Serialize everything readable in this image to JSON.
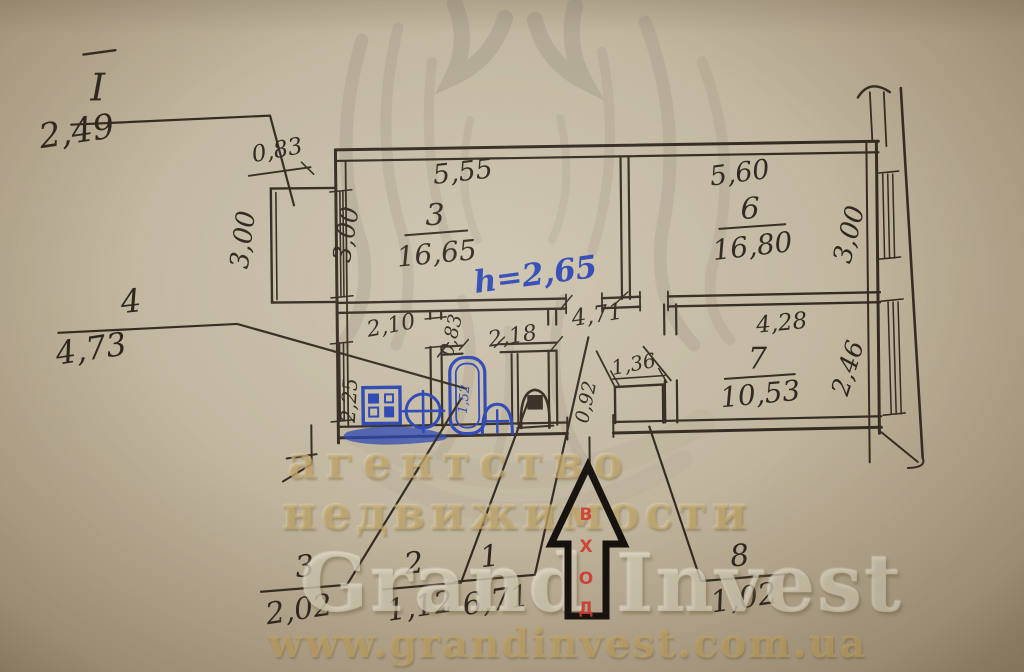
{
  "watermark": {
    "line1": "агентство",
    "line2": "недвижимости",
    "brand": "Grand Invest",
    "url": "www.grandinvest.com.ua"
  },
  "plan": {
    "height_note": "h=2,65",
    "entrance": {
      "l1": "В",
      "l2": "Х",
      "l3": "О",
      "l4": "Д"
    },
    "rooms": {
      "room3": {
        "num": "3",
        "area": "16,65"
      },
      "room6": {
        "num": "6",
        "area": "16,80"
      },
      "room7": {
        "num": "7",
        "area": "10,53"
      }
    },
    "dims": {
      "balcony_depth": "0,83",
      "balcony_height": "3,00",
      "room3_width": "5,55",
      "room3_height": "3,00",
      "room6_width": "5,60",
      "room6_height": "3,00",
      "room7_width": "4,28",
      "room7_height": "2,46",
      "kitchen_width": "2,10",
      "kitchen_depth": "2,25",
      "wc_width": "0,83",
      "bath_width": "2,18",
      "hall_length": "4,71",
      "closet_width": "1,36",
      "bath_depth": "0,92",
      "tub_length": "1,52"
    },
    "callouts": {
      "c_i": {
        "num": "I",
        "value": "2,49"
      },
      "c4": {
        "num": "4",
        "value": "4,73"
      },
      "c3": {
        "num": "3",
        "value": "2,02"
      },
      "c2": {
        "num": "2",
        "value": "1,12"
      },
      "c1": {
        "num": "1",
        "value": "6,71"
      },
      "c8": {
        "num": "8",
        "value": "1,02"
      }
    }
  },
  "colors": {
    "ink": "#2f2720",
    "blue": "#2b45b4",
    "red": "#d03a30",
    "paper": "#c3b8a1",
    "wm_gold": "#c8aa68"
  }
}
